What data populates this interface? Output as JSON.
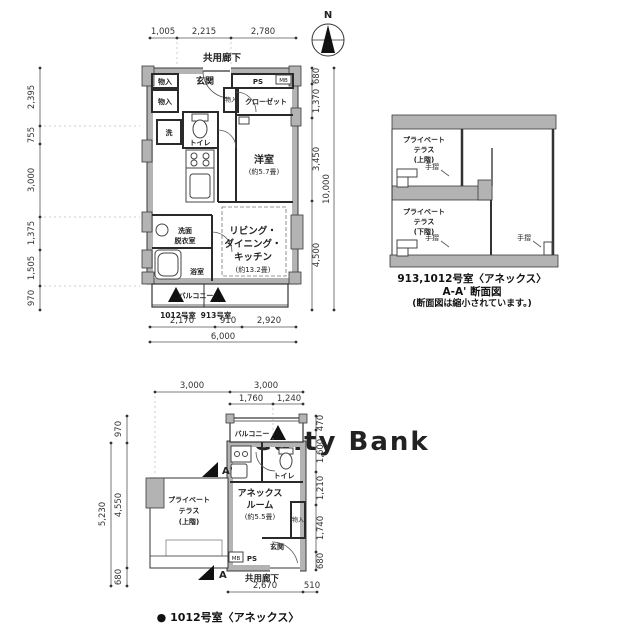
{
  "watermark": "Realty Bank",
  "compass": {
    "north_label": "N"
  },
  "top_plan": {
    "corridor_label": "共用廊下",
    "dims_top": [
      "1,005",
      "2,215",
      "2,780"
    ],
    "dims_left": [
      "2,395",
      "755",
      "3,000",
      "1,375",
      "1,505",
      "970"
    ],
    "dims_right": [
      "680",
      "1,370",
      "3,450",
      "4,500"
    ],
    "dim_right_total": "10,000",
    "dims_bottom": [
      "2,170",
      "910",
      "2,920"
    ],
    "dim_bottom_total": "6,000",
    "rooms": {
      "entrance": "玄関",
      "storage_top": "物入",
      "storage_left": "物入",
      "storage_mid": "物入",
      "ps": "PS",
      "mb": "MB",
      "closet": "クローゼット",
      "washer": "洗",
      "toilet": "トイレ",
      "bedroom": "洋室",
      "bedroom_size": "(約5.7畳)",
      "washroom_line1": "洗面",
      "washroom_line2": "脱衣室",
      "bathroom": "浴室",
      "ldk_line1": "リビング・",
      "ldk_line2": "ダイニング・",
      "ldk_line3": "キッチン",
      "ldk_size": "(約13.2畳)",
      "balcony": "バルコニー",
      "unit_1012": "1012号室",
      "unit_913": "913号室"
    }
  },
  "section": {
    "terrace_upper_line1": "プライベート",
    "terrace_upper_line2": "テラス",
    "terrace_upper_line3": "(上階)",
    "terrace_lower_line1": "プライベート",
    "terrace_lower_line2": "テラス",
    "terrace_lower_line3": "(下階)",
    "handrail1": "手摺",
    "handrail2": "手摺",
    "handrail3": "手摺",
    "caption_line1": "913,1012号室〈アネックス〉",
    "caption_line2": "A-A' 断面図",
    "caption_line3": "(断面図は縮小されています。)"
  },
  "bottom_plan": {
    "dims_top_row1": [
      "3,000",
      "3,000"
    ],
    "dims_top_row2": [
      "1,760",
      "1,240"
    ],
    "dims_left": [
      "970",
      "4,550",
      "680"
    ],
    "dim_left_total": "5,230",
    "dims_right": [
      "470",
      "1,600",
      "1,210",
      "1,740",
      "680"
    ],
    "dims_bottom": [
      "2,670",
      "510"
    ],
    "rooms": {
      "balcony": "バルコニー",
      "toilet": "トイレ",
      "annex_line1": "アネックス",
      "annex_line2": "ルーム",
      "annex_size": "(約5.5畳)",
      "storage": "物入",
      "entrance": "玄関",
      "mb": "MB",
      "ps": "PS",
      "corridor": "共用廊下",
      "terrace_line1": "プライベート",
      "terrace_line2": "テラス",
      "terrace_line3": "(上階)"
    },
    "marker_a_prime": "A'",
    "marker_a": "A",
    "caption": "● 1012号室〈アネックス〉"
  }
}
